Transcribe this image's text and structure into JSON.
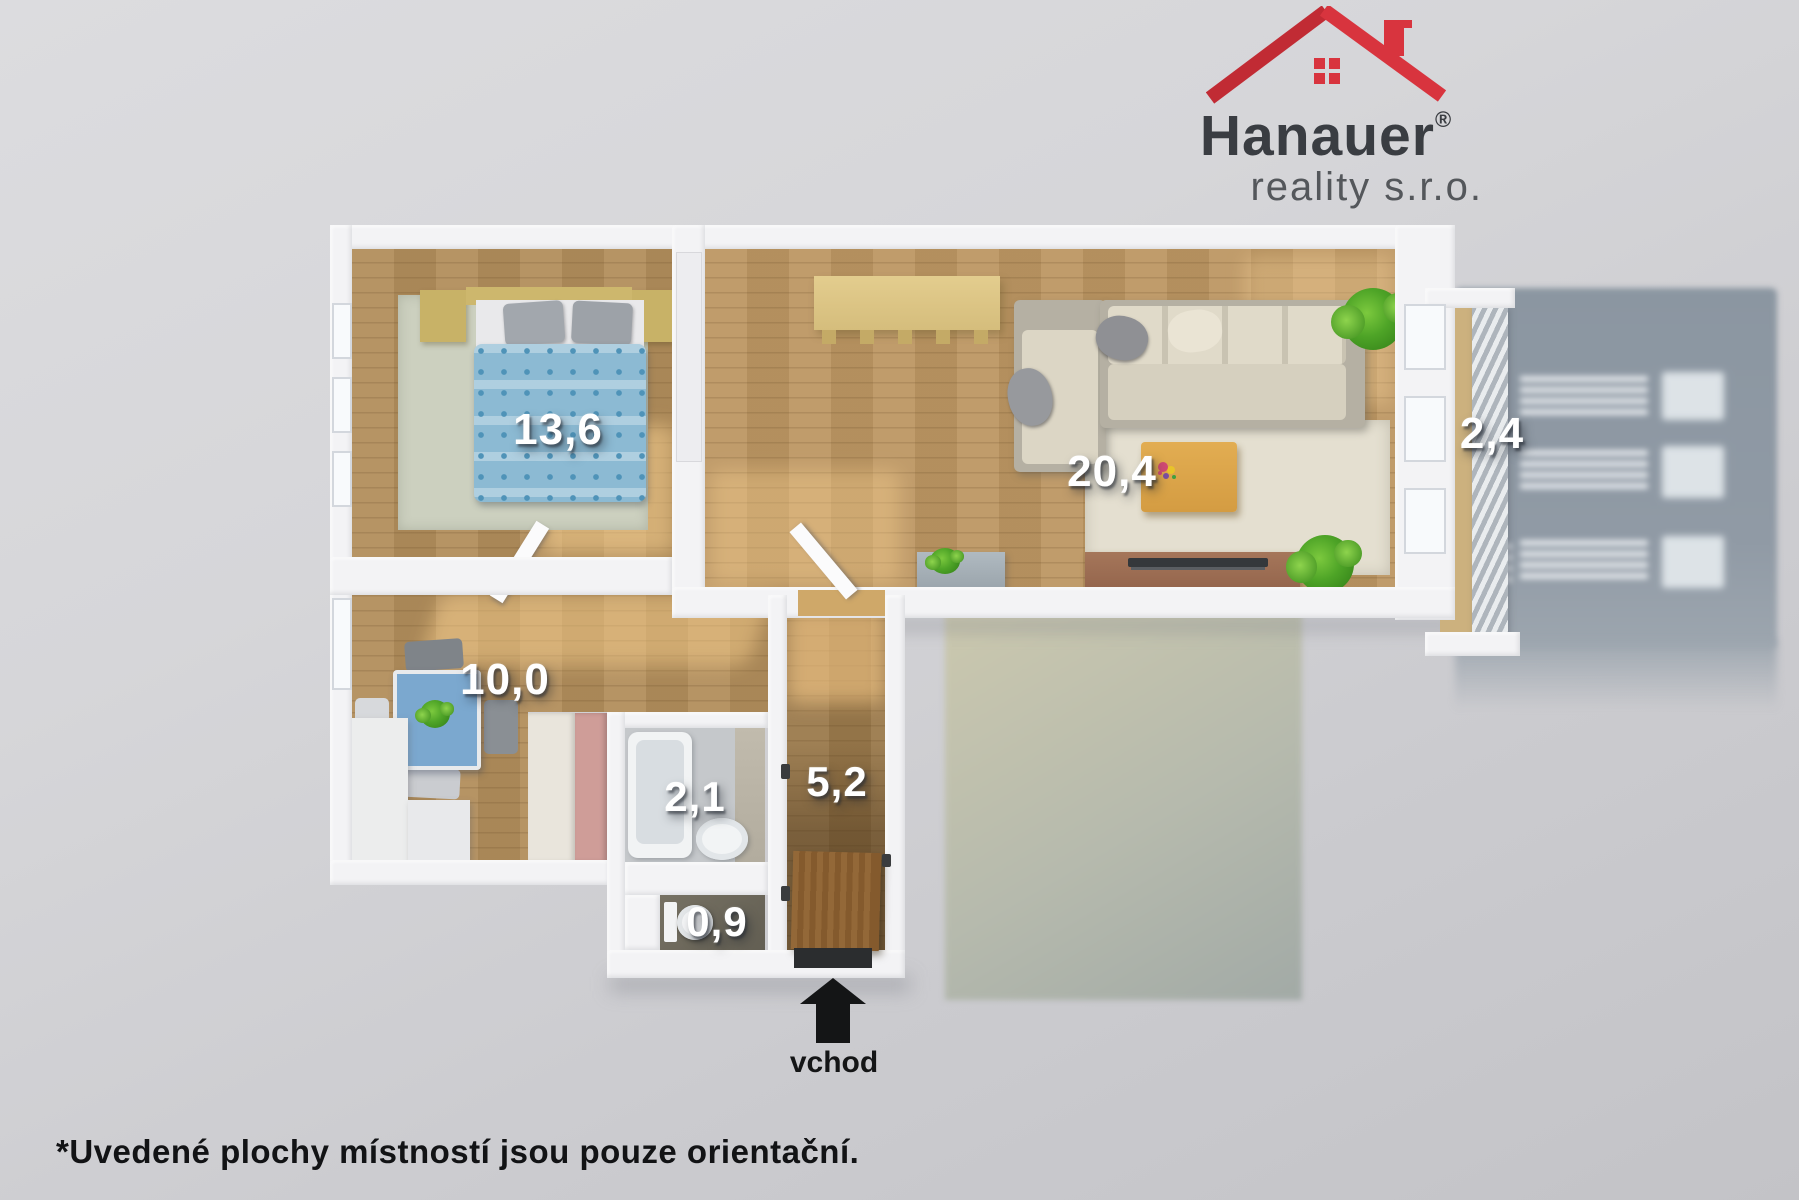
{
  "logo": {
    "name": "Hanauer",
    "registered": "®",
    "subtitle": "reality s.r.o.",
    "roof_color_left": "#c12b34",
    "roof_color_right": "#d8343e",
    "text_color": "#3a3d42"
  },
  "rooms": [
    {
      "id": "bedroom",
      "area": "13,6"
    },
    {
      "id": "living-room",
      "area": "20,4"
    },
    {
      "id": "balcony",
      "area": "2,4"
    },
    {
      "id": "kitchen",
      "area": "10,0"
    },
    {
      "id": "bathroom",
      "area": "2,1"
    },
    {
      "id": "hallway",
      "area": "5,2"
    },
    {
      "id": "wc",
      "area": "0,9"
    }
  ],
  "entrance": {
    "label": "vchod"
  },
  "footnote": "*Uvedené plochy místností jsou pouze orientační.",
  "colors": {
    "background": "#d2d2d6",
    "wall": "#f3f3f5",
    "wood_floor": "#b28e5c",
    "building_shadow": "#8b96a1",
    "ground_shadow_beige": "#bdbda8",
    "duvet_blue": "#8cbad3",
    "pink_wall": "#cf9d98",
    "label_text": "#ffffff"
  }
}
